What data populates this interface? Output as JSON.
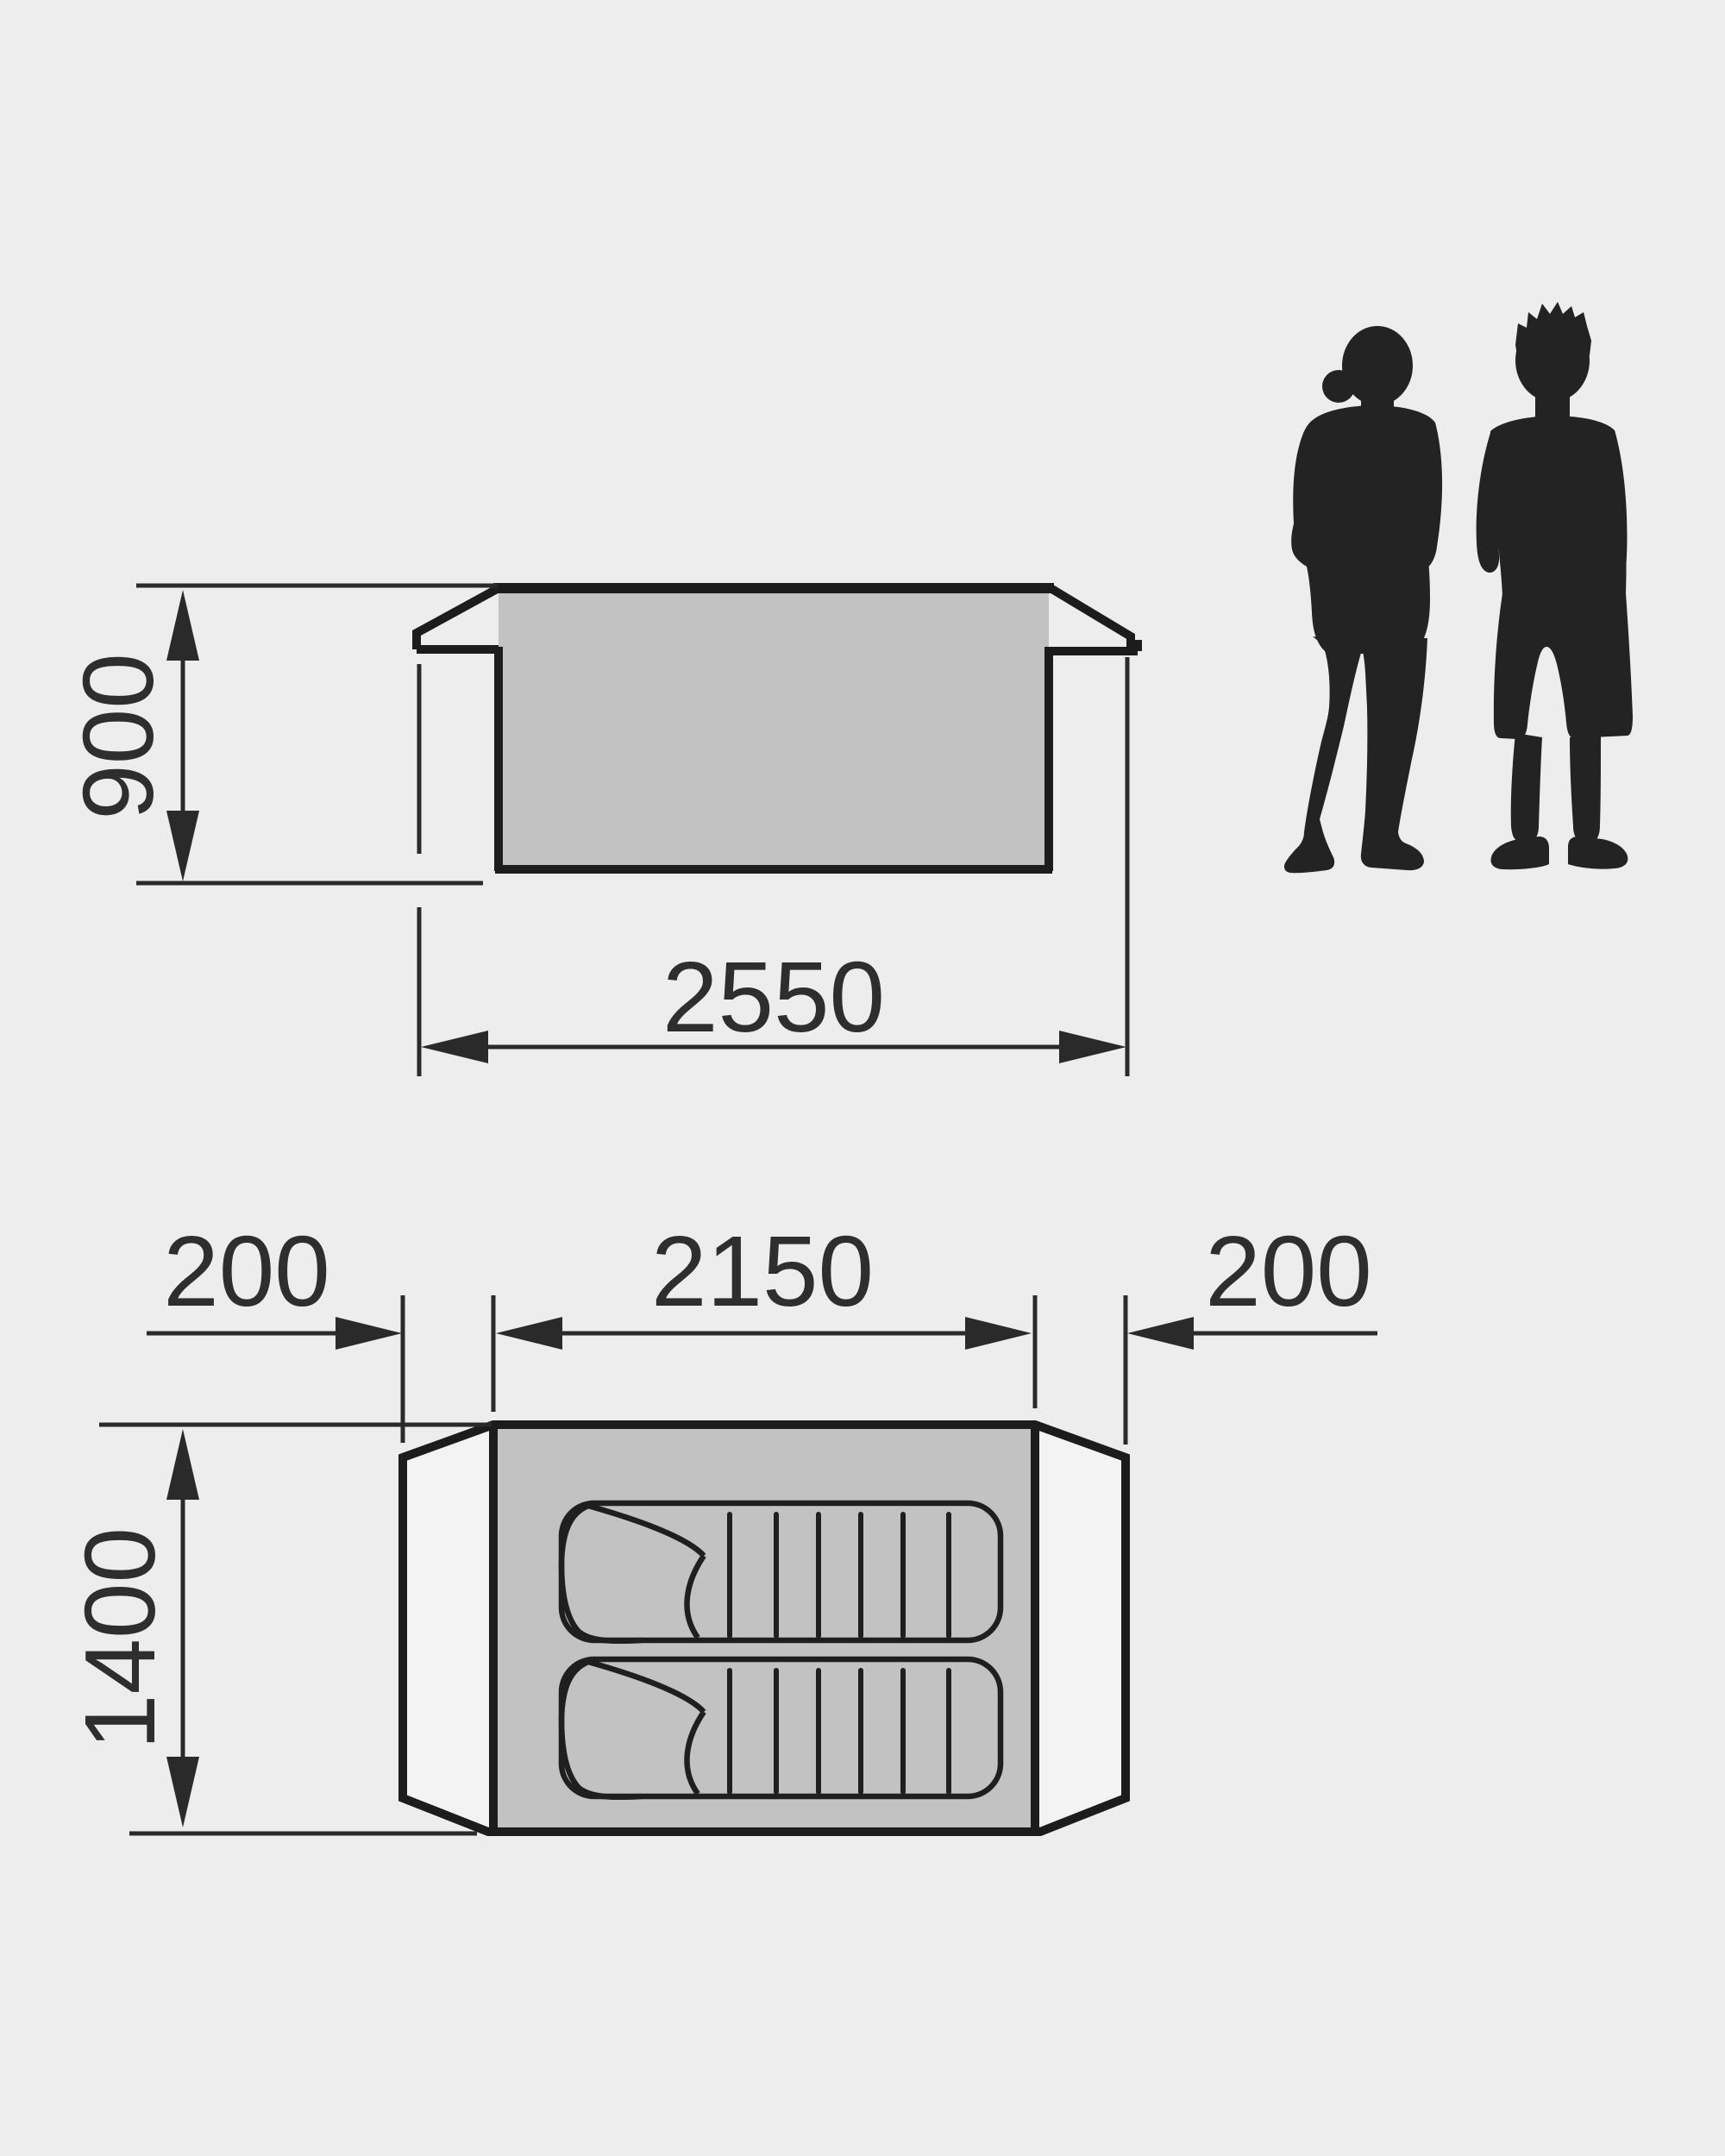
{
  "diagram_type": "tent dimension drawing, side elevation and floor plan",
  "colors": {
    "background": "#ededed",
    "panel_gray": "#c2c2c2",
    "vestibule_white": "#f3f3f3",
    "line_bold": "#1c1c1c",
    "line_thin": "#2a2a2a",
    "text": "#2e2e2e",
    "silhouette": "#232323"
  },
  "side_view": {
    "height_label": "900",
    "length_label": "2550"
  },
  "floor_plan": {
    "left_porch_label": "200",
    "inner_length_label": "2150",
    "right_porch_label": "200",
    "width_label": "1400",
    "sleeping_bag_count": 2,
    "quilt_lines_per_bag": 6
  },
  "figures": {
    "count": 2,
    "description": "two standing adult silhouettes shown for scale"
  }
}
